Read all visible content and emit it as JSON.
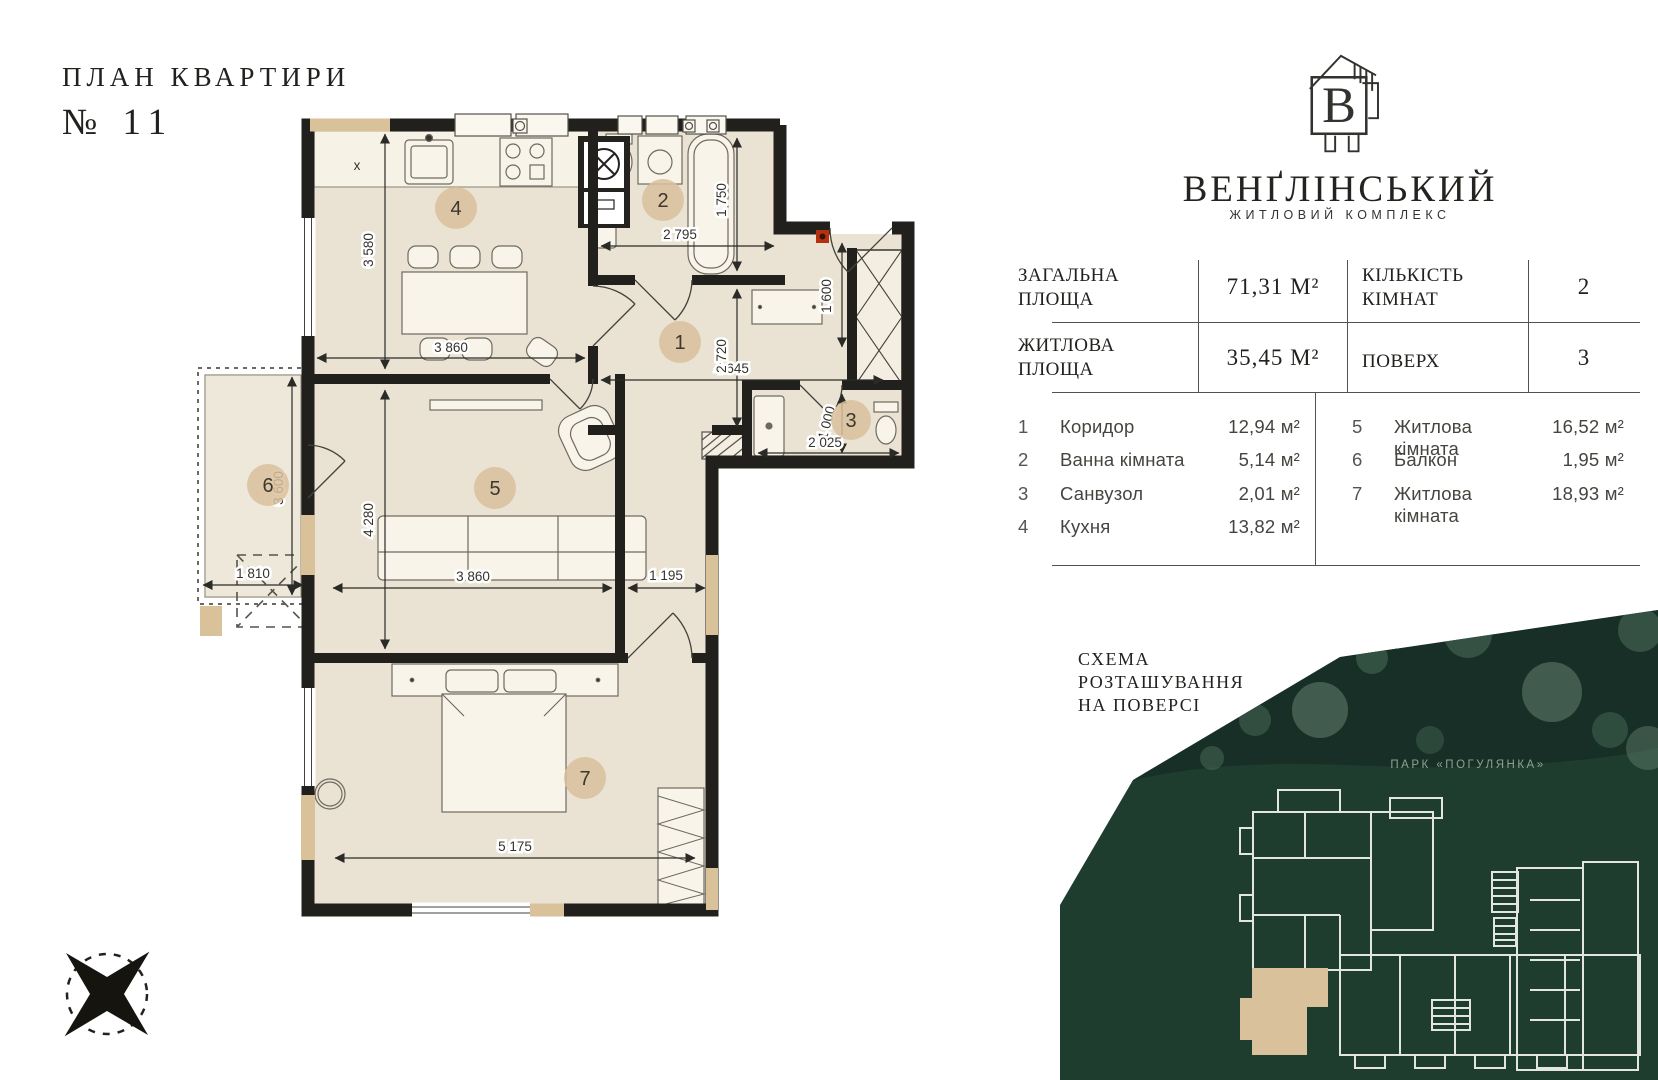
{
  "page": {
    "title_line1": "ПЛАН КВАРТИРИ",
    "title_line2": "№ 11"
  },
  "brand": {
    "name": "ВЕНҐЛІНСЬКИЙ",
    "tagline": "ЖИТЛОВИЙ КОМПЛЕКС",
    "logo_letter": "B"
  },
  "summary": {
    "rows": [
      {
        "label": "ЗАГАЛЬНА ПЛОЩА",
        "value": "71,31 М²",
        "label2": "КІЛЬКІСТЬ КІМНАТ",
        "value2": "2"
      },
      {
        "label": "ЖИТЛОВА ПЛОЩА",
        "value": "35,45 М²",
        "label2": "ПОВЕРХ",
        "value2": "3"
      }
    ]
  },
  "room_list": {
    "left": [
      {
        "num": "1",
        "name": "Коридор",
        "area": "12,94 м²"
      },
      {
        "num": "2",
        "name": "Ванна кімната",
        "area": "5,14 м²"
      },
      {
        "num": "3",
        "name": "Санвузол",
        "area": "2,01 м²"
      },
      {
        "num": "4",
        "name": "Кухня",
        "area": "13,82 м²"
      }
    ],
    "right": [
      {
        "num": "5",
        "name": "Житлова кімната",
        "area": "16,52 м²"
      },
      {
        "num": "6",
        "name": "Балкон",
        "area": "1,95 м²"
      },
      {
        "num": "7",
        "name": "Житлова кімната",
        "area": "18,93 м²"
      }
    ]
  },
  "schema": {
    "heading_line1": "СХЕМА",
    "heading_line2": "РОЗТАШУВАННЯ",
    "heading_line3": "НА ПОВЕРСІ",
    "park_label": "ПАРК «ПОГУЛЯНКА»"
  },
  "plan": {
    "x_mark": "x",
    "room_numbers": {
      "hall": "1",
      "bath": "2",
      "wc": "3",
      "kitchen": "4",
      "living": "5",
      "balcony": "6",
      "bedroom": "7"
    },
    "dims": {
      "kitchen_h": "3 580",
      "kitchen_w": "3 860",
      "bath_w": "2 795",
      "bath_h": "1 750",
      "hall_w": "4 645",
      "hall_h": "2 720",
      "entry_h": "1 600",
      "wc_w": "2 025",
      "wc_h": "1 000",
      "living_w": "3 860",
      "living_h": "4 280",
      "nub_w": "1 195",
      "balcony_w": "1 810",
      "balcony_h": "3 600",
      "bedroom_w": "5 175"
    }
  },
  "colors": {
    "wall": "#21201d",
    "room_fill": "#eae3d4",
    "accent_tan": "#d9c29a",
    "marker_fill": "#d9c09b",
    "map_green": "#1f3d2f",
    "map_band": "#172f26",
    "tree_green": "#4e6e5b",
    "park_text": "#8da293",
    "alert_red": "#b3310f"
  }
}
